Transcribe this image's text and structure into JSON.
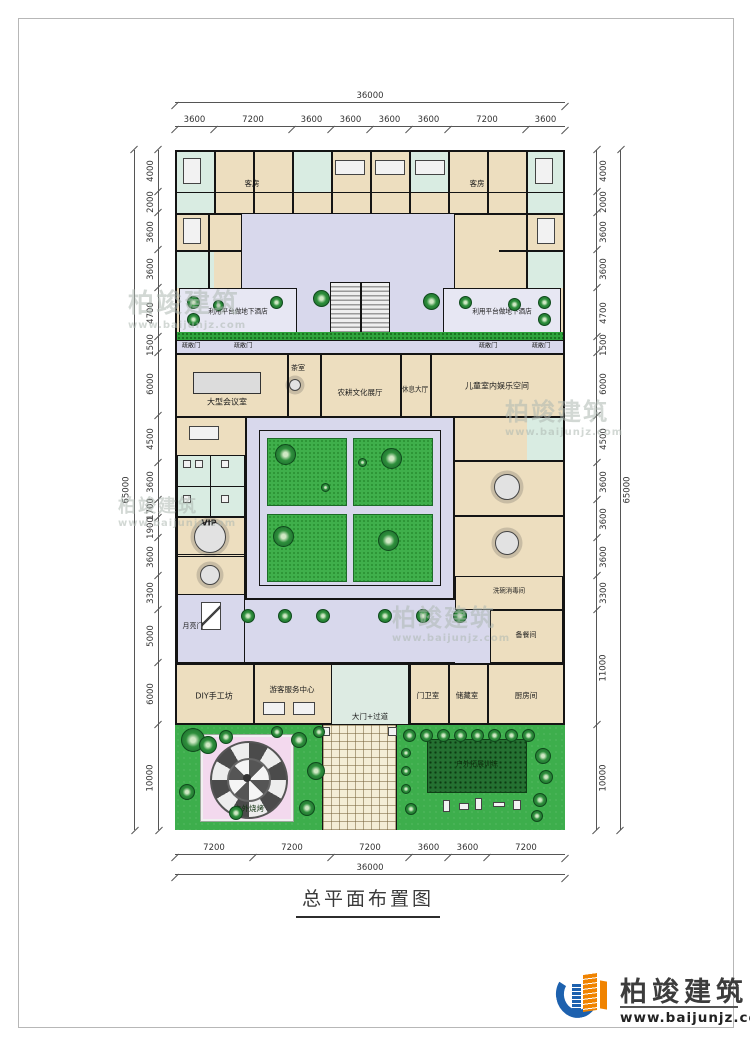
{
  "frame": {
    "title": "总平面布置图"
  },
  "watermark": {
    "brand": "柏竣建筑",
    "url": "www.baijunjz.com"
  },
  "logo": {
    "brand": "柏竣建筑",
    "url": "www.baijunjz.com"
  },
  "dimensions": {
    "top": {
      "total": "36000",
      "segments": [
        "3600",
        "7200",
        "3600",
        "3600",
        "3600",
        "3600",
        "7200",
        "3600"
      ]
    },
    "bottom": {
      "total": "36000",
      "segments": [
        "7200",
        "7200",
        "7200",
        "3600",
        "3600",
        "7200"
      ]
    },
    "left": {
      "total": "65000",
      "segments": [
        "4000",
        "2000",
        "3600",
        "3600",
        "4700",
        "1500",
        "6000",
        "4500",
        "3600",
        "1700",
        "1900",
        "3600",
        "3300",
        "5000",
        "6000",
        "10000"
      ]
    },
    "right": {
      "total": "65000",
      "segments": [
        "4000",
        "2000",
        "3600",
        "3600",
        "4700",
        "1500",
        "6000",
        "4500",
        "3600",
        "3600",
        "3600",
        "3300",
        "11000",
        "10000"
      ]
    }
  },
  "rooms": {
    "guest_room": "客房",
    "terrace": "利用平台做地下酒店",
    "evac_door": "疏散门",
    "conference": "大型会议室",
    "tea": "茶室",
    "exhibition": "农耕文化展厅",
    "rest_hall": "休息大厅",
    "kids": "儿童室内娱乐空间",
    "vip": "VIP",
    "moon_gate": "月亮门",
    "dishwash": "洗碗消毒间",
    "prep": "备餐间",
    "diy": "DIY手工坊",
    "visitor_center": "游客服务中心",
    "gate": "大门+过道",
    "guard": "门卫室",
    "storage": "储藏室",
    "kitchen": "厨房间",
    "bbq": "户外烧烤",
    "training": "户外拓展训练"
  },
  "colors": {
    "room_fill": "#EDDEBF",
    "corridor_fill": "#D8D8EC",
    "bath_fill": "#D9ECE2",
    "lawn": "#3DAE4C",
    "logo_blue": "#1d61ae",
    "logo_orange": "#f08300"
  }
}
